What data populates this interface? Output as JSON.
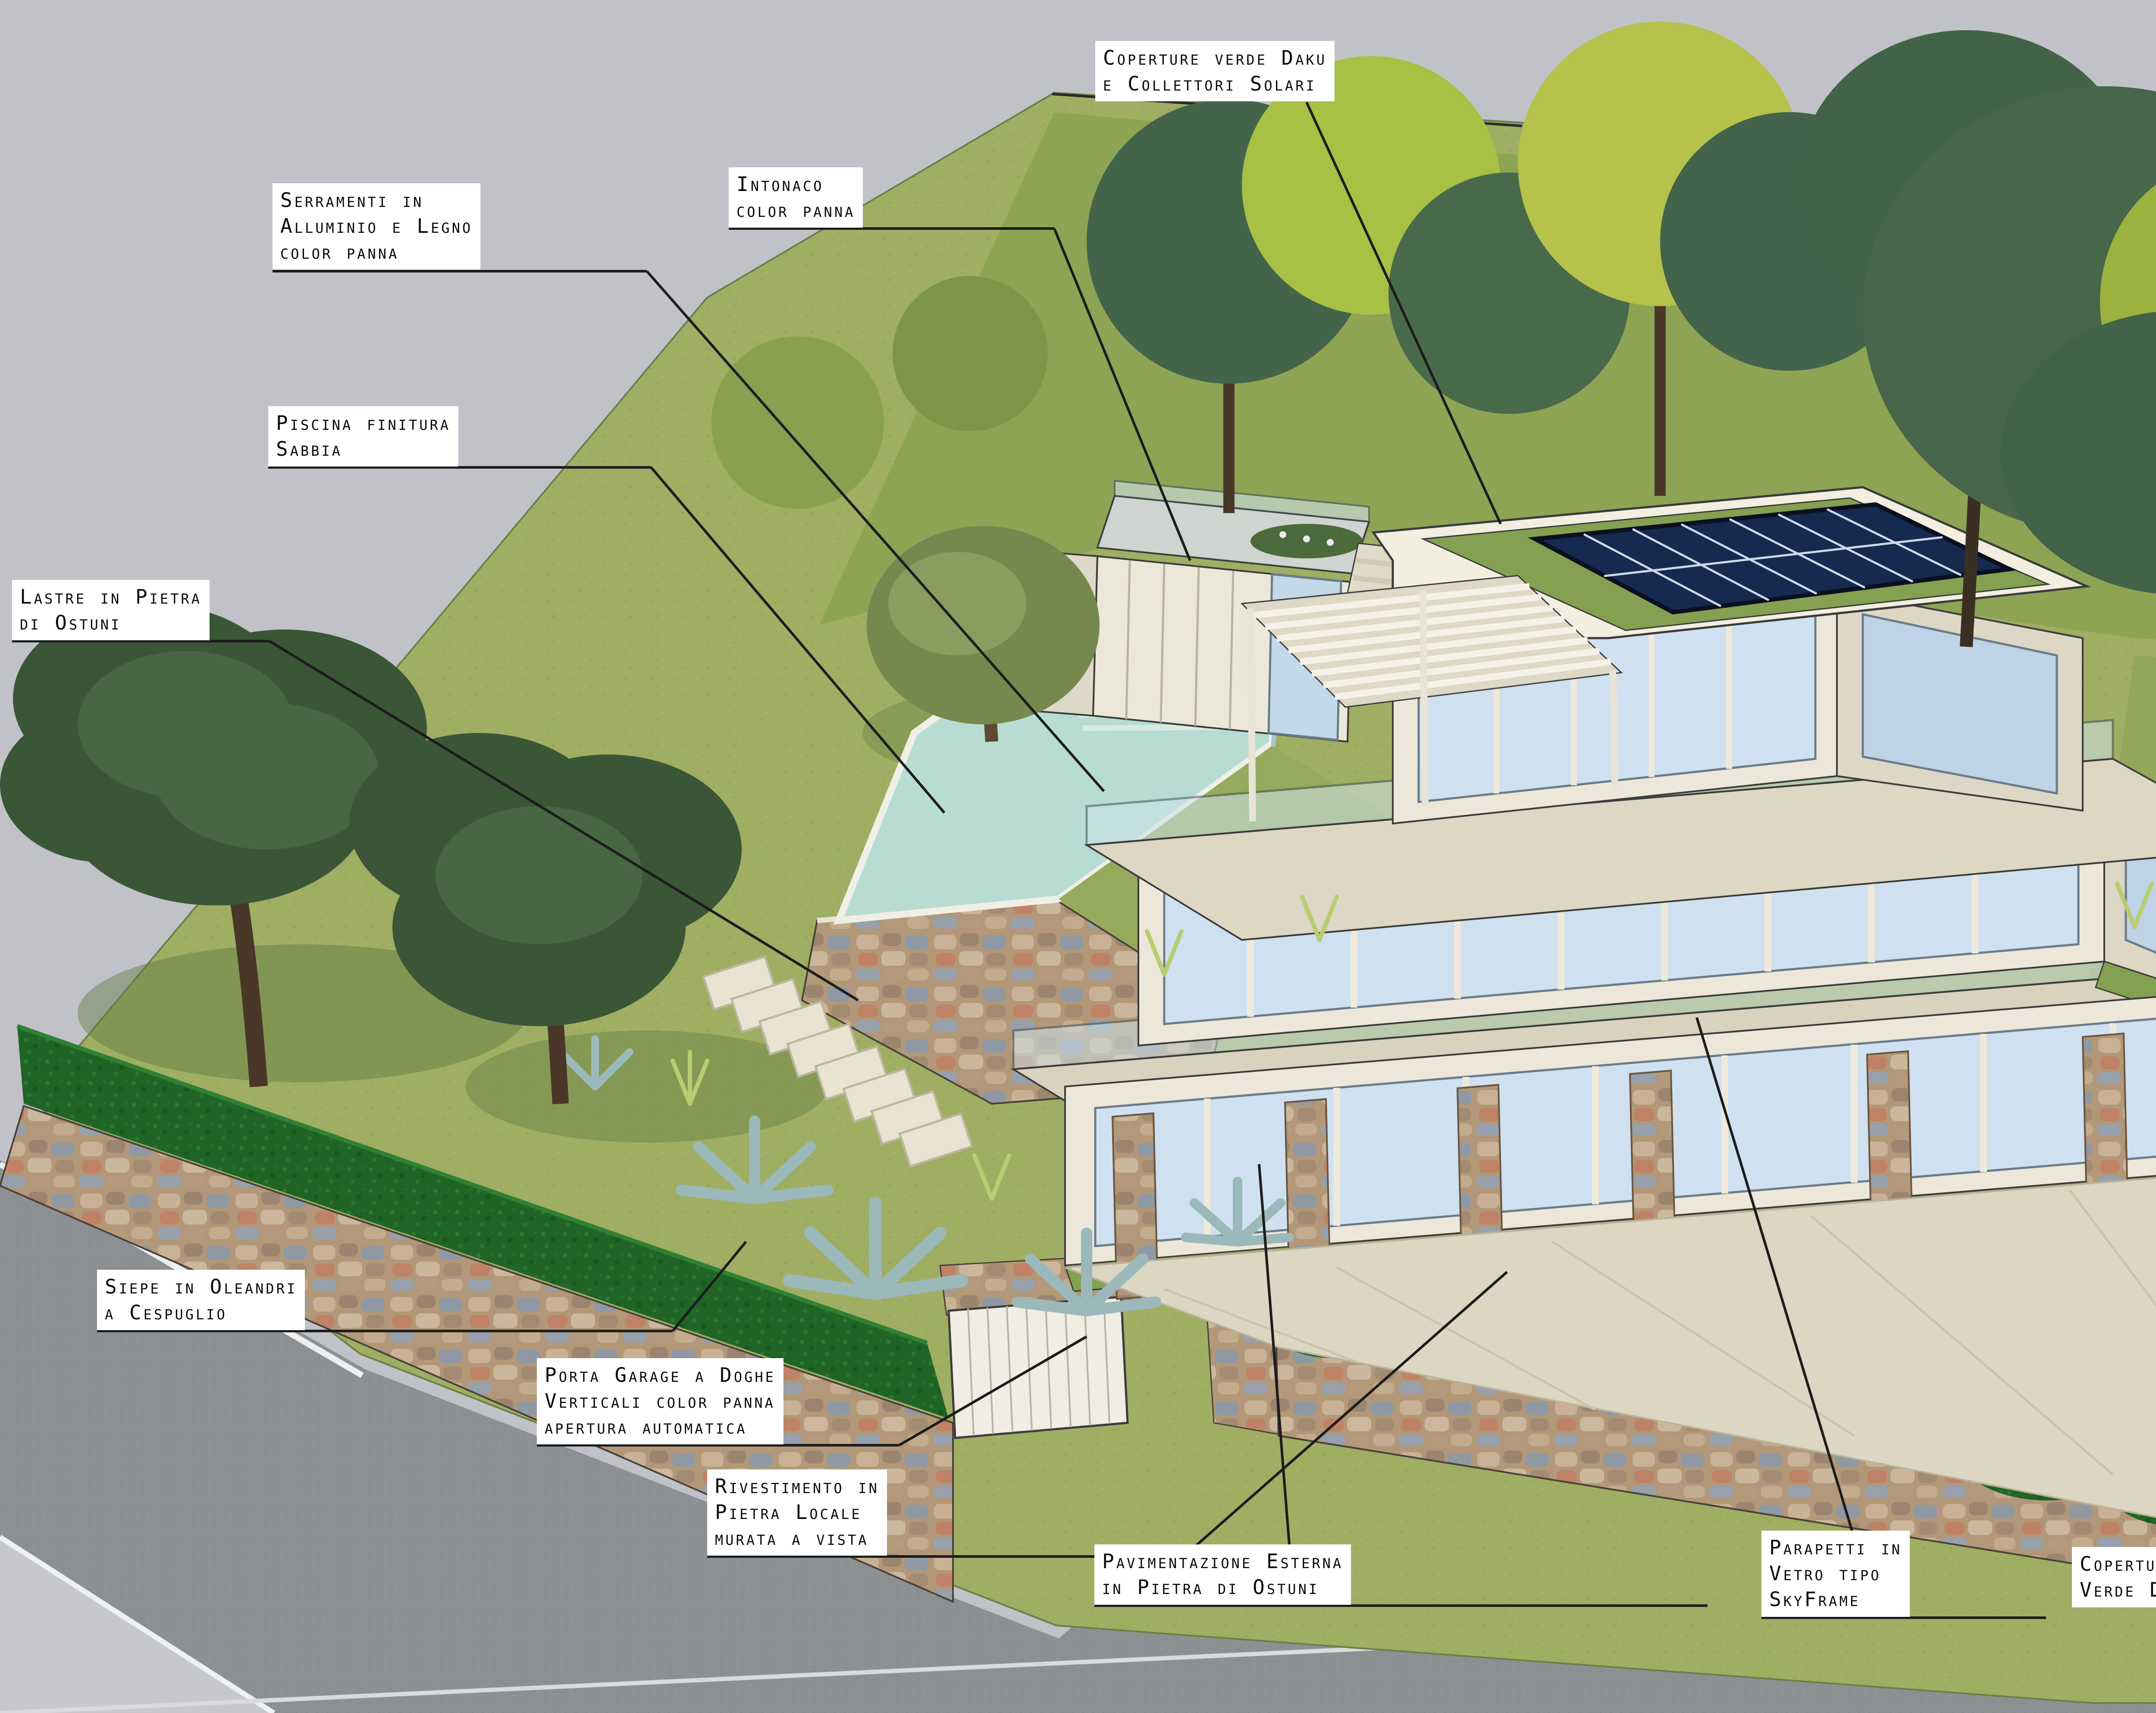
{
  "title": "Rendering architettonico villa con annotazioni materiali",
  "annotations": {
    "coperture_solari": "Coperture verde Daku\ne Collettori Solari",
    "serramenti": "Serramenti in\nAlluminio e Legno\ncolor panna",
    "intonaco": "Intonaco\ncolor panna",
    "piscina": "Piscina finitura\nSabbia",
    "lastre": "Lastre in Pietra\ndi Ostuni",
    "pietra_ostuni": "Pietra di\nOstuni",
    "copertura_verde_right": "Copertura\nVerde Daku",
    "siepe": "Siepe in Oleandri\na Cespuglio",
    "porta_garage": "Porta Garage a Doghe\nVerticali color panna\napertura automatica",
    "rivestimento": "Rivestimento in\nPietra Locale\nmurata a vista",
    "pavimentazione": "Pavimentazione Esterna\nin Pietra di Ostuni",
    "parapetti": "Parapetti in\nVetro tipo\nSkyFrame",
    "copertura_verde_bottom": "Copertura\nVerde Daku"
  },
  "colors": {
    "background_gray": "#c0c2c8",
    "road_gray": "#8d9092",
    "sidewalk_gray": "#c6c8cc",
    "grass_light": "#9fae63",
    "grass_dark": "#87a04f",
    "hedge_green": "#206426",
    "green_roof": "#84a051",
    "wall_cream": "#ece7d8",
    "window_blue": "#cfe1f0",
    "pool_aqua": "#b7dcd2",
    "stone_tan": "#b29878",
    "solar_blue": "#16294e",
    "paving_beige": "#d8d2be",
    "label_bg": "#ffffff",
    "label_text": "#0a0a0a",
    "leader_line": "#1c1c1c"
  }
}
